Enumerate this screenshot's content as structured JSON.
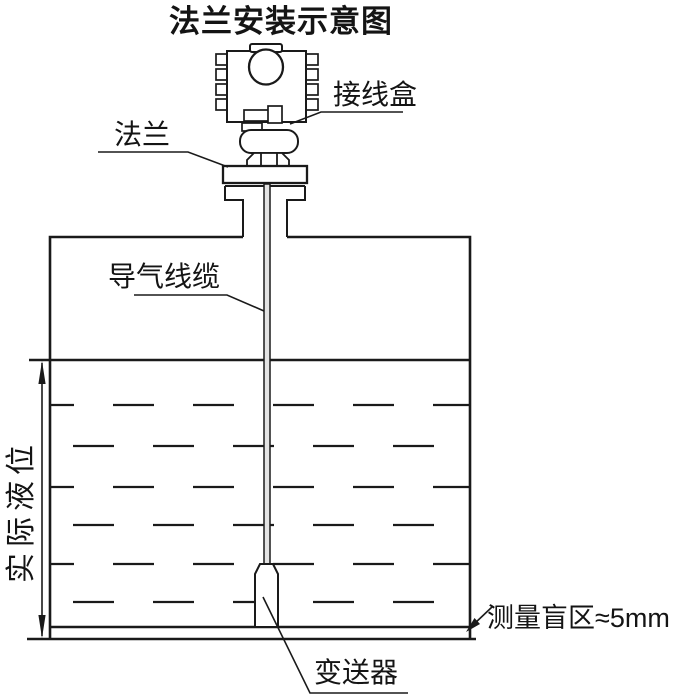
{
  "title": "法兰安装示意图",
  "labels": {
    "junction_box": "接线盒",
    "flange": "法兰",
    "air_cable": "导气线缆",
    "actual_level": "实际液位",
    "transmitter": "变送器",
    "blind_zone": "测量盲区≈5mm"
  },
  "colors": {
    "line": "#1a1a1a",
    "background": "#ffffff",
    "cable_fill": "#e3e3e3"
  }
}
